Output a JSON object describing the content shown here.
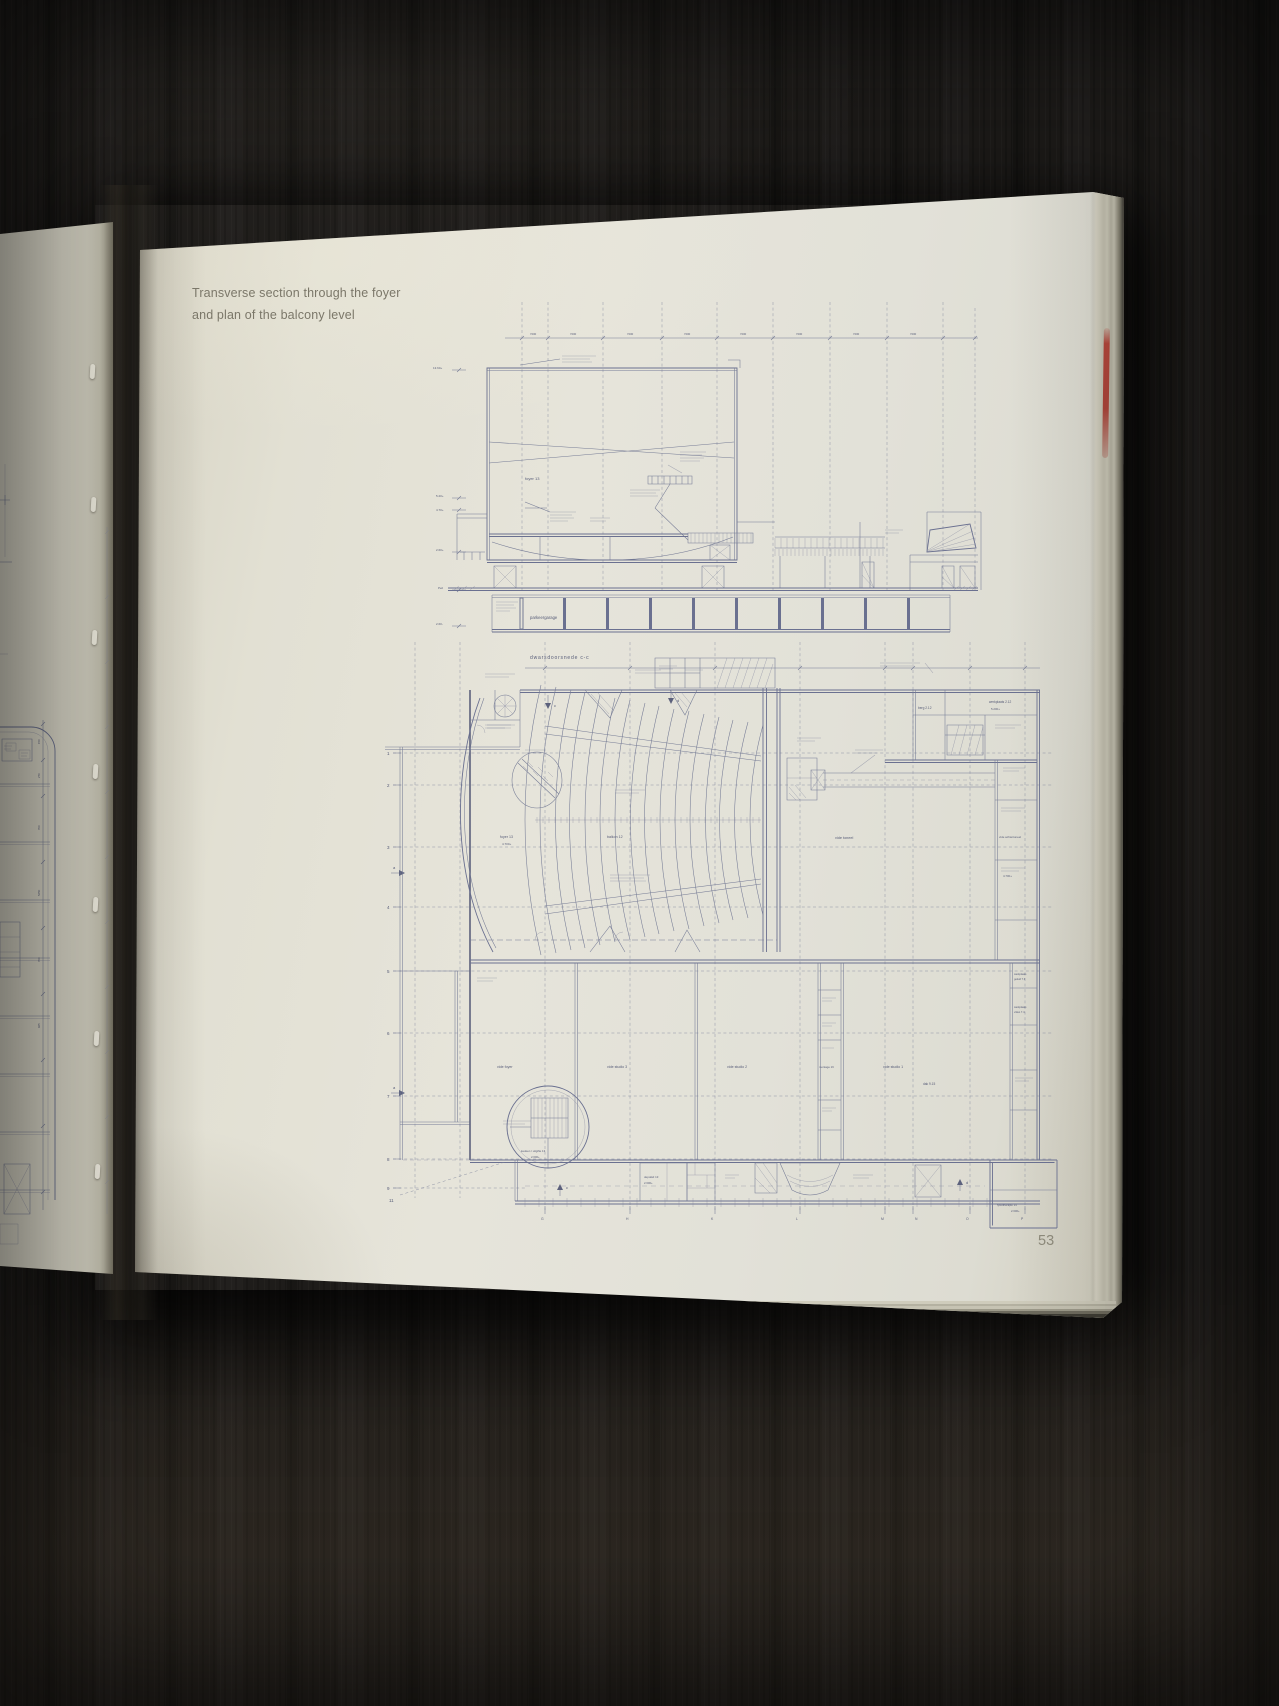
{
  "page": {
    "title_line1": "Transverse section through the foyer",
    "title_line2": "and plan of the balcony level",
    "number": "53"
  },
  "section": {
    "caption": "dwarsdoorsnede c-c",
    "foyer_label": "foyer 13",
    "garage_label": "parkeergarage",
    "levels": [
      "13.60+",
      "5.20+",
      "4.70+",
      "2.60+",
      "Peil",
      "2.60-"
    ],
    "dims": [
      "7200",
      "7200",
      "7200",
      "7200",
      "7200",
      "7200",
      "7200",
      "7200"
    ]
  },
  "plan": {
    "grid_rows": [
      "1",
      "2",
      "3",
      "4",
      "5",
      "6",
      "7",
      "8",
      "9"
    ],
    "grid_row_eleven": "11",
    "grid_letters": [
      "G",
      "H",
      "K",
      "L",
      "M",
      "N",
      "O",
      "P"
    ],
    "marker_a": "a",
    "marker_c": "c",
    "marker_d": "d",
    "rooms": {
      "foyer": "foyer 13",
      "balkon": "balkon 12",
      "vide_toneel": "vide toneel",
      "vide_achtertoneel": "vide achtertoneel",
      "berg": "berg 2.12",
      "werkplaats": "werkplaats 2.12",
      "vide_foyer": "vide foyer",
      "vide_studio3": "vide studio 3",
      "vide_studio2": "vide studio 2",
      "montage": "montage 16",
      "vide_studio1": "vide studio 1",
      "dak": "dak 9.15",
      "wp_geluid_1": "werkplaats",
      "wp_geluid_2": "geluid 7.3",
      "wp_video_1": "werkplaats",
      "wp_video_2": "video 7.4",
      "keuken": "keuken / uitgifte 13",
      "depot": "depotkd 13",
      "fysio": "fysiotherapie 14"
    },
    "levels": {
      "foyer": "4.700+",
      "keuken": "2.600+",
      "depot": "2.600+",
      "fysio": "2.600+",
      "werkplaats": "5.200+",
      "rechts": "4.700+"
    }
  },
  "left_page": {
    "dims": [
      "150",
      "270",
      "700",
      "5250",
      "700",
      "925"
    ]
  },
  "colors": {
    "ink": "#757b95",
    "page": "#e4e2d6",
    "red_mark": "#a6362c",
    "wood": "#1d1b19"
  }
}
